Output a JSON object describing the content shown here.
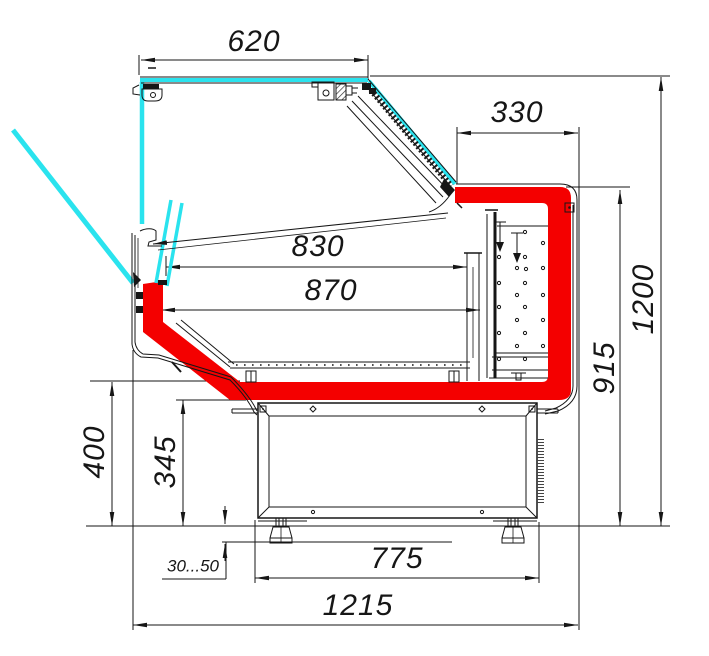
{
  "drawing": {
    "dimensions": {
      "canopy_width": "620",
      "back_counter_depth": "330",
      "display_opening_depth": "830",
      "display_well_depth": "870",
      "overall_height": "1200",
      "counter_height": "915",
      "front_panel_height": "400",
      "base_height": "345",
      "leg_adjust_range": "30...50",
      "base_depth": "775",
      "overall_depth": "1215"
    },
    "colors": {
      "highlight_red": "#f40000",
      "glass_cyan": "#2ae3ee",
      "line_black": "#161616"
    }
  }
}
